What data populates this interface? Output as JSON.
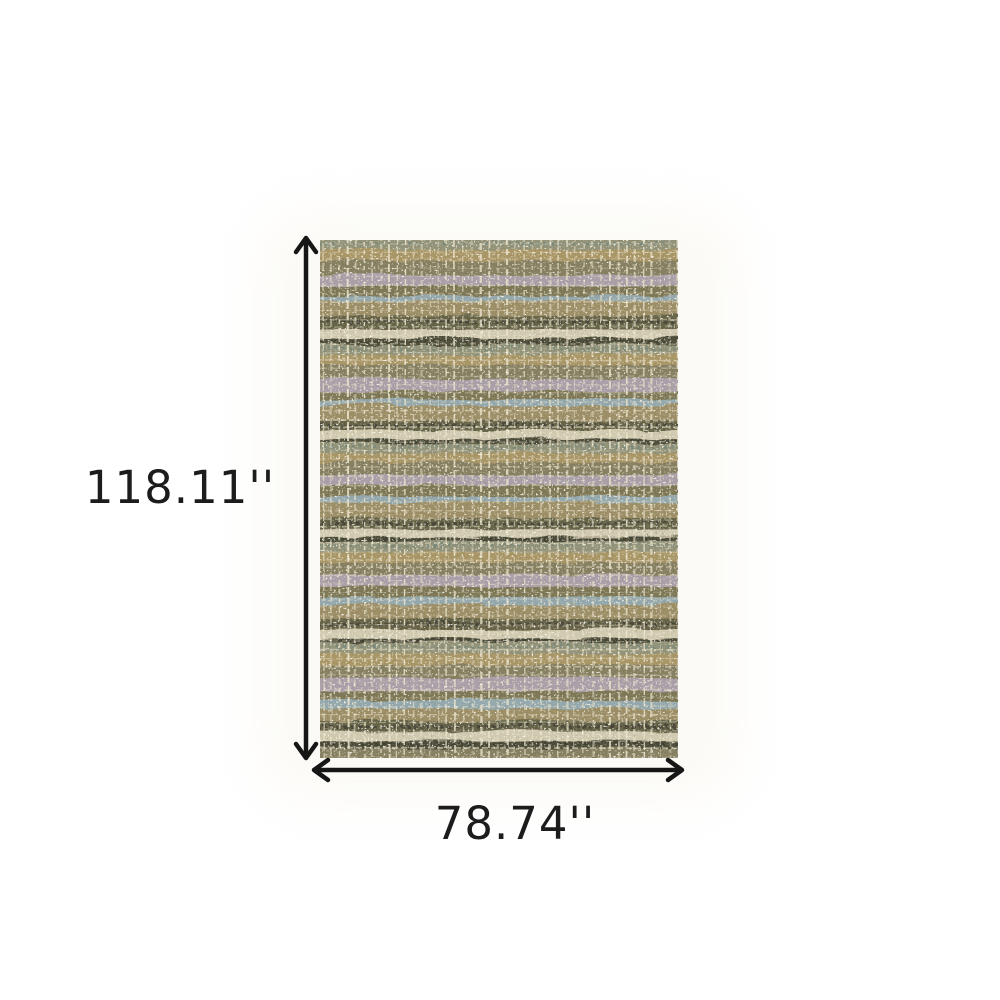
{
  "diagram": {
    "background_color": "#ffffff",
    "arrow_color": "#161616",
    "label_color": "#1c1c1c",
    "height": {
      "label": "118.11''"
    },
    "width": {
      "label": "78.74''"
    }
  },
  "rug": {
    "description": "green ivory multicolor textured grid area rug swatch",
    "grid_line_color": "#ebe4ca",
    "grid_line_color_h": "#ded7be",
    "speckle_light_color": "#ede6cc",
    "speckle_dark_color": "#3a3928",
    "stitch_dark_color": "#3a392b",
    "stitch_teal_color": "#5e7a74",
    "repeats": 5,
    "repeat_bands": [
      {
        "color": "#8d8d72",
        "h": 10
      },
      {
        "color": "#a4905f",
        "h": 10
      },
      {
        "color": "#80795a",
        "h": 14
      },
      {
        "color": "#a59aa3",
        "h": 12
      },
      {
        "color": "#77714f",
        "h": 10
      },
      {
        "color": "#8ea3a8",
        "h": 6
      },
      {
        "color": "#97885f",
        "h": 14
      },
      {
        "color": "#5e5c41",
        "h": 12
      },
      {
        "color": "#cdc6ab",
        "h": 10
      },
      {
        "color": "#4a4936",
        "h": 6
      }
    ]
  }
}
